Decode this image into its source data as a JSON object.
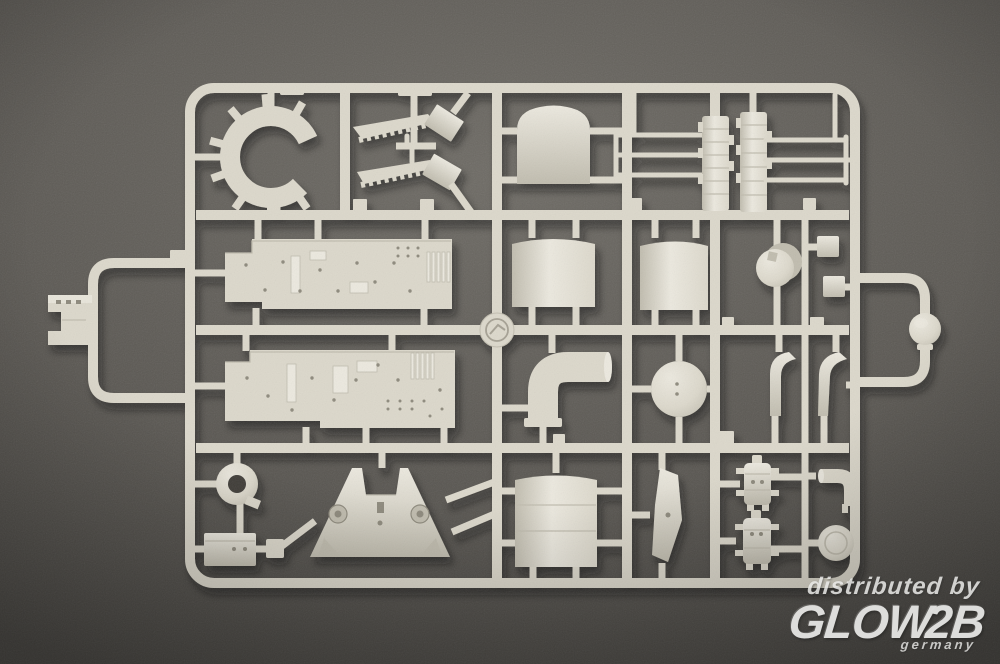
{
  "scene": {
    "subject": "plastic model kit parts sprue photographed on dark textured surface"
  },
  "watermark": {
    "distributed_by": "distributed by",
    "brand": "GLOW",
    "brand_suffix": "2B",
    "country": "germany"
  },
  "colors": {
    "bg_center": "#6e6b65",
    "bg_mid": "#5b5853",
    "bg_edge": "#413f3b",
    "bg_hole": "#3f3d39",
    "plastic": "#dcd8cb",
    "plastic_light": "#ece9df",
    "plastic_dark": "#c0bcae",
    "plastic_shadow": "#8d897b",
    "watermark": "#ebebe9"
  },
  "parts": [
    "sprue-frame",
    "gun-barrel-ring",
    "saw-tooth-rail-upper",
    "saw-tooth-rail-lower",
    "angled-plate-upper",
    "angled-plate-lower",
    "arched-panel",
    "segmented-mast-block-left",
    "segmented-mast-block-right",
    "mast-rods",
    "deck-section-upper",
    "deck-section-lower",
    "funnel-panel-top-left",
    "funnel-panel-top-right",
    "cylinder-drum",
    "small-cube-upper",
    "small-cube-lower",
    "funnel-elbow-duct",
    "circular-platform-disc",
    "curved-bracket-left",
    "curved-bracket-right",
    "logo-medallion",
    "ring-mount-donut",
    "small-equipment-box",
    "bridge-superstructure-front",
    "funnel-panel-bottom",
    "keel-blade",
    "equipment-mount-upper",
    "equipment-mount-lower",
    "small-elbow-pipe",
    "round-hatch-disc",
    "searchlight-dome",
    "notched-block"
  ]
}
